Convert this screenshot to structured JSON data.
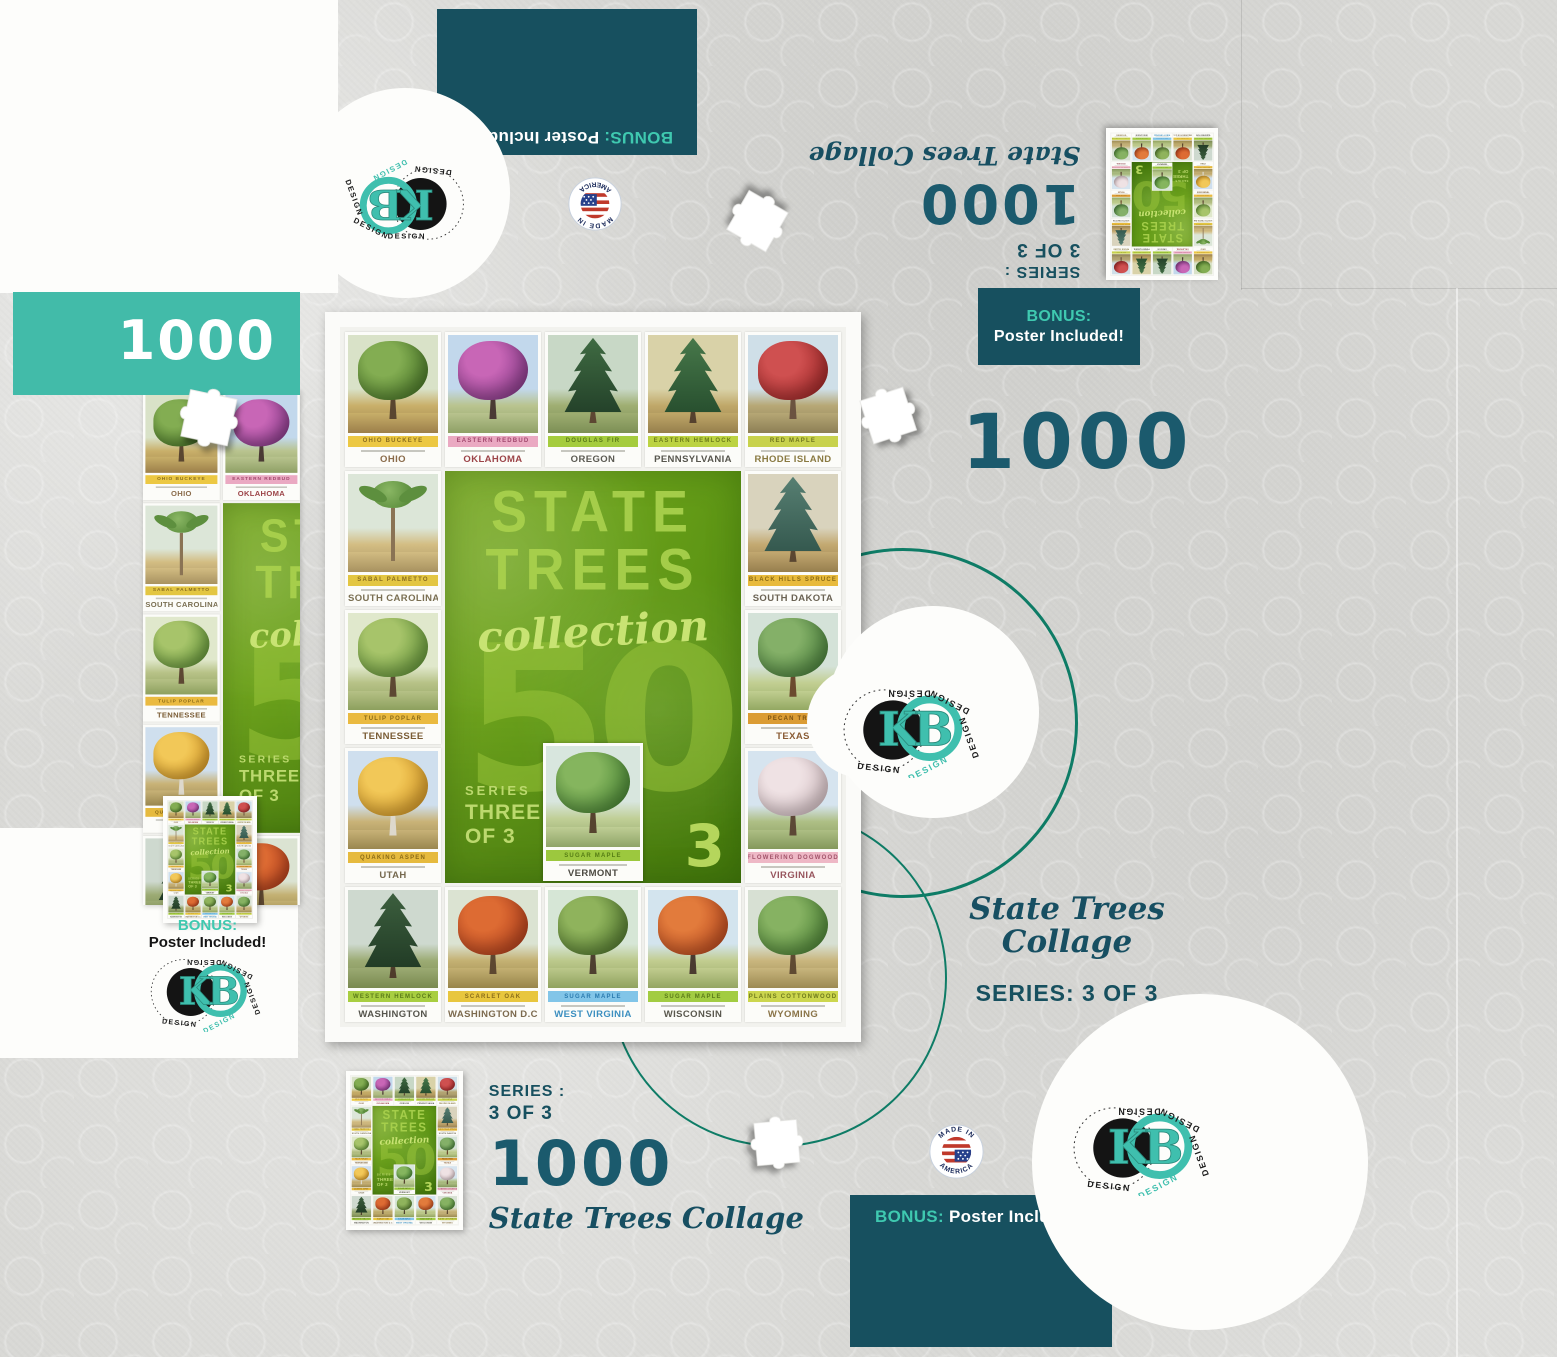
{
  "colors": {
    "paper": "#d9d9d6",
    "dark_teal_box": "#17505f",
    "light_teal_box": "#42bba9",
    "accent_teal": "#3fc9b0",
    "number_teal": "#1b5a6d",
    "circle_teal": "#0e7c66",
    "green_panel": "#69a01a",
    "green_text": "#a9d14d"
  },
  "brand": {
    "kb": "KB",
    "design_word": "DESIGN"
  },
  "made_in": {
    "top": "MADE IN",
    "bottom": "AMERICA"
  },
  "bonus": {
    "label": "BONUS:",
    "text": "Poster Included!"
  },
  "count": "1000",
  "collage_title": "State Trees Collage",
  "collage_title_l1": "State Trees",
  "collage_title_l2": "Collage",
  "series_inline": "SERIES: 3 OF 3",
  "series_label": "SERIES :",
  "series_value": "3 OF 3",
  "puzzle": {
    "center": {
      "title1": "STATE",
      "title2": "TREES",
      "script": "collection",
      "big": "50",
      "series_label": "SERIES",
      "series_l1": "THREE",
      "series_l2": "OF 3",
      "corner": "3"
    },
    "cards": [
      {
        "state": "OHIO",
        "species": "Ohio Buckeye",
        "type": "round",
        "band": "#ecc843",
        "bandfg": "#8a6d1f",
        "name": "#8a6b4a",
        "f1": "#4f7d2c",
        "f2": "#83ad52",
        "tr": "#5a4630",
        "sky": "#d9e2c8",
        "g1": "#c9b06a",
        "g2": "#9c7f4a"
      },
      {
        "state": "OKLAHOMA",
        "species": "Eastern Redbud",
        "type": "round",
        "band": "#eaa9c2",
        "bandfg": "#a2486e",
        "name": "#9c4448",
        "f1": "#8e3f8e",
        "f2": "#c866b6",
        "tr": "#4a3a34",
        "sky": "#c2d8ec",
        "g1": "#b9c48f",
        "g2": "#8fa066"
      },
      {
        "state": "OREGON",
        "species": "Douglas Fir",
        "type": "conifer",
        "band": "#a5cc3e",
        "bandfg": "#5a7a18",
        "name": "#5b5a52",
        "f1": "#24422a",
        "f2": "#3f6b42",
        "tr": "#5c4632",
        "sky": "#c8d8c6",
        "g1": "#9fae72",
        "g2": "#7c8f55"
      },
      {
        "state": "PENNSYLVANIA",
        "species": "Eastern Hemlock",
        "type": "conifer",
        "band": "#bcd342",
        "bandfg": "#6c7c1a",
        "name": "#57564e",
        "f1": "#28502f",
        "f2": "#47784a",
        "tr": "#55412e",
        "sky": "#d9d2a8",
        "g1": "#c0a869",
        "g2": "#967f4c"
      },
      {
        "state": "RHODE ISLAND",
        "species": "Red Maple",
        "type": "round",
        "band": "#c8d24c",
        "bandfg": "#70761e",
        "name": "#8a7a42",
        "f1": "#a62c2c",
        "f2": "#cf5050",
        "tr": "#6b5340",
        "sky": "#cfdfe8",
        "g1": "#b7a876",
        "g2": "#8d7f55"
      },
      {
        "state": "SOUTH CAROLINA",
        "species": "Sabal Palmetto",
        "type": "palm",
        "band": "#e3c642",
        "bandfg": "#8a6d1f",
        "name": "#7a6f52",
        "f1": "#5d8f3e",
        "f2": "#8ab764",
        "tr": "#8a7354",
        "sky": "#dce6d8",
        "g1": "#d3bd83",
        "g2": "#a89260"
      },
      {
        "state": "SOUTH DAKOTA",
        "species": "Black Hills Spruce",
        "type": "conifer",
        "band": "#e8ba3c",
        "bandfg": "#8a6a16",
        "name": "#6b6354",
        "f1": "#35594f",
        "f2": "#577f72",
        "tr": "#5a4631",
        "sky": "#d9d3bd",
        "g1": "#c3a971",
        "g2": "#977f4e"
      },
      {
        "state": "TENNESSEE",
        "species": "Tulip Poplar",
        "type": "round",
        "band": "#eaba40",
        "bandfg": "#8a6a16",
        "name": "#7a5c35",
        "f1": "#6a9a3e",
        "f2": "#a7c46a",
        "tr": "#5d4833",
        "sky": "#e0e8cc",
        "g1": "#b7c287",
        "g2": "#8da05e"
      },
      {
        "state": "TEXAS",
        "species": "Pecan Tree",
        "type": "round",
        "band": "#db9c34",
        "bandfg": "#7c5210",
        "name": "#8a5c35",
        "f1": "#4f8540",
        "f2": "#84b068",
        "tr": "#6b4a2e",
        "sky": "#d4e2d8",
        "g1": "#c2cf92",
        "g2": "#93a862"
      },
      {
        "state": "UTAH",
        "species": "Quaking Aspen",
        "type": "round",
        "band": "#e6ba3e",
        "bandfg": "#8a6a16",
        "name": "#76694f",
        "f1": "#d99e2c",
        "f2": "#f2c858",
        "tr": "#ddd8cc",
        "sky": "#cfdfee",
        "g1": "#c9b378",
        "g2": "#9a874f"
      },
      {
        "state": "VIRGINIA",
        "species": "Flowering Dogwood",
        "type": "round",
        "band": "#eeb8c6",
        "bandfg": "#a2546a",
        "name": "#97555d",
        "f1": "#d8c4c8",
        "f2": "#efe2e4",
        "tr": "#5c4836",
        "sky": "#d6e4ef",
        "g1": "#aebf85",
        "g2": "#84985c"
      },
      {
        "state": "WASHINGTON",
        "species": "Western Hemlock",
        "type": "conifer",
        "band": "#a8ce41",
        "bandfg": "#5a7a18",
        "name": "#56554d",
        "f1": "#223c26",
        "f2": "#3c5f3e",
        "tr": "#4e3b2b",
        "sky": "#ced9cf",
        "g1": "#9cab74",
        "g2": "#79894f"
      },
      {
        "state": "WASHINGTON D.C.",
        "species": "Scarlet Oak",
        "type": "round",
        "band": "#e8c63e",
        "bandfg": "#8a6d1a",
        "name": "#7c6a4e",
        "f1": "#b8441f",
        "f2": "#dd6b33",
        "tr": "#5d4730",
        "sky": "#dbe3d2",
        "g1": "#c4b173",
        "g2": "#98854a"
      },
      {
        "state": "WEST VIRGINIA",
        "species": "Sugar Maple",
        "type": "round",
        "band": "#82c5e8",
        "bandfg": "#2a7aae",
        "name": "#3c8fc0",
        "f1": "#587f33",
        "f2": "#8fb35c",
        "tr": "#4e3f30",
        "sky": "#d6e6d6",
        "g1": "#bcc98c",
        "g2": "#90a25e"
      },
      {
        "state": "WISCONSIN",
        "species": "Sugar Maple",
        "type": "round",
        "band": "#a2cc42",
        "bandfg": "#5a7a18",
        "name": "#5a584e",
        "f1": "#c04f22",
        "f2": "#e27b3c",
        "tr": "#4a3a30",
        "sky": "#d3e4ee",
        "g1": "#c2cd90",
        "g2": "#94a562"
      },
      {
        "state": "WYOMING",
        "species": "Plains Cottonwood",
        "type": "round",
        "band": "#ccd64e",
        "bandfg": "#6f7a1c",
        "name": "#8a7448",
        "f1": "#52883a",
        "f2": "#86b262",
        "tr": "#5f4a32",
        "sky": "#d7e0d3",
        "g1": "#c9b67e",
        "g2": "#9c8a52"
      }
    ],
    "vermont": {
      "state": "VERMONT",
      "species": "Sugar Maple",
      "type": "round",
      "band": "#9cc83e",
      "bandfg": "#557c14",
      "name": "#4c4a42",
      "f1": "#4e8a38",
      "f2": "#85b55e",
      "tr": "#55432f",
      "sky": "#d8e6de",
      "g1": "#c0cf96",
      "g2": "#8fa468"
    }
  }
}
